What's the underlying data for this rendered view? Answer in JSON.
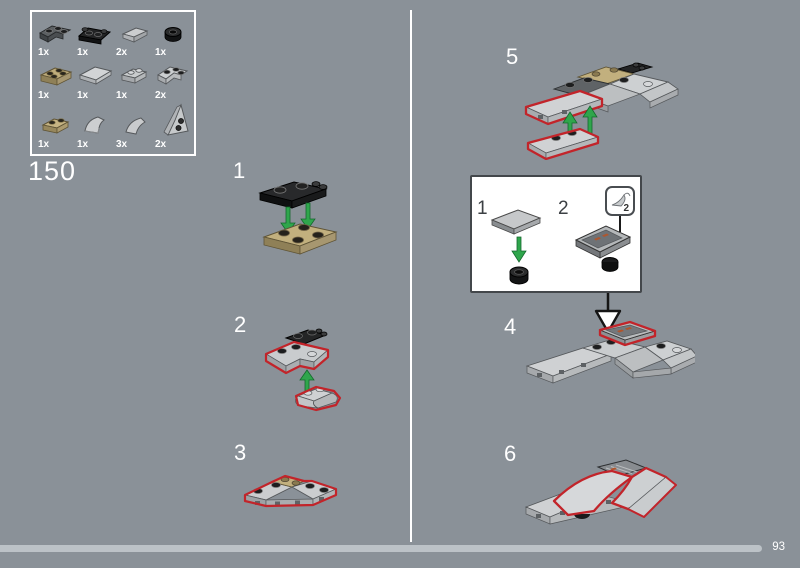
{
  "page": {
    "bag_number": "150",
    "page_number": "93",
    "progress_percent": 95,
    "background_color": "#8a9198",
    "highlight_red": "#c2242a",
    "arrow_green": "#2fa64c"
  },
  "parts_panel": {
    "parts": [
      {
        "qty": "1x",
        "name": "corner-plate-2x2-dark-gray"
      },
      {
        "qty": "1x",
        "name": "plate-1x2-with-clips-black"
      },
      {
        "qty": "2x",
        "name": "slope-tile-light-gray"
      },
      {
        "qty": "1x",
        "name": "round-plate-1x1-black"
      },
      {
        "qty": "1x",
        "name": "plate-2x2-dark-tan"
      },
      {
        "qty": "1x",
        "name": "tile-2x2-light-gray"
      },
      {
        "qty": "1x",
        "name": "plate-1x2-light-gray"
      },
      {
        "qty": "2x",
        "name": "corner-wedge-plate-light-gray"
      },
      {
        "qty": "1x",
        "name": "plate-1x2-tan"
      },
      {
        "qty": "1x",
        "name": "curved-slope-light-gray"
      },
      {
        "qty": "3x",
        "name": "curved-slope-small-light-gray"
      },
      {
        "qty": "2x",
        "name": "wedge-plate-tall-light-gray"
      }
    ]
  },
  "steps": [
    {
      "number": "1"
    },
    {
      "number": "2"
    },
    {
      "number": "3"
    },
    {
      "number": "4"
    },
    {
      "number": "5"
    },
    {
      "number": "6"
    }
  ],
  "inset": {
    "substeps": [
      {
        "number": "1"
      },
      {
        "number": "2"
      }
    ],
    "sticker_number": "2"
  }
}
